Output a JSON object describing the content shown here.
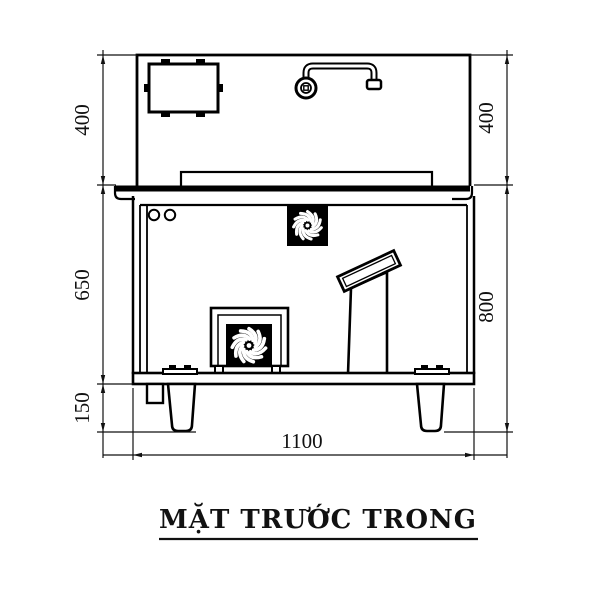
{
  "drawing": {
    "title": "MẶT TRƯỚC TRONG",
    "dims": {
      "left_top": "400",
      "left_middle": "650",
      "left_bottom": "150",
      "right_top": "400",
      "right_bottom": "800",
      "bottom_width": "1100"
    },
    "colors": {
      "line": "#000000",
      "background": "#ffffff"
    },
    "icons": [
      "fan-impeller-icon",
      "faucet-icon",
      "control-box-icon"
    ]
  }
}
